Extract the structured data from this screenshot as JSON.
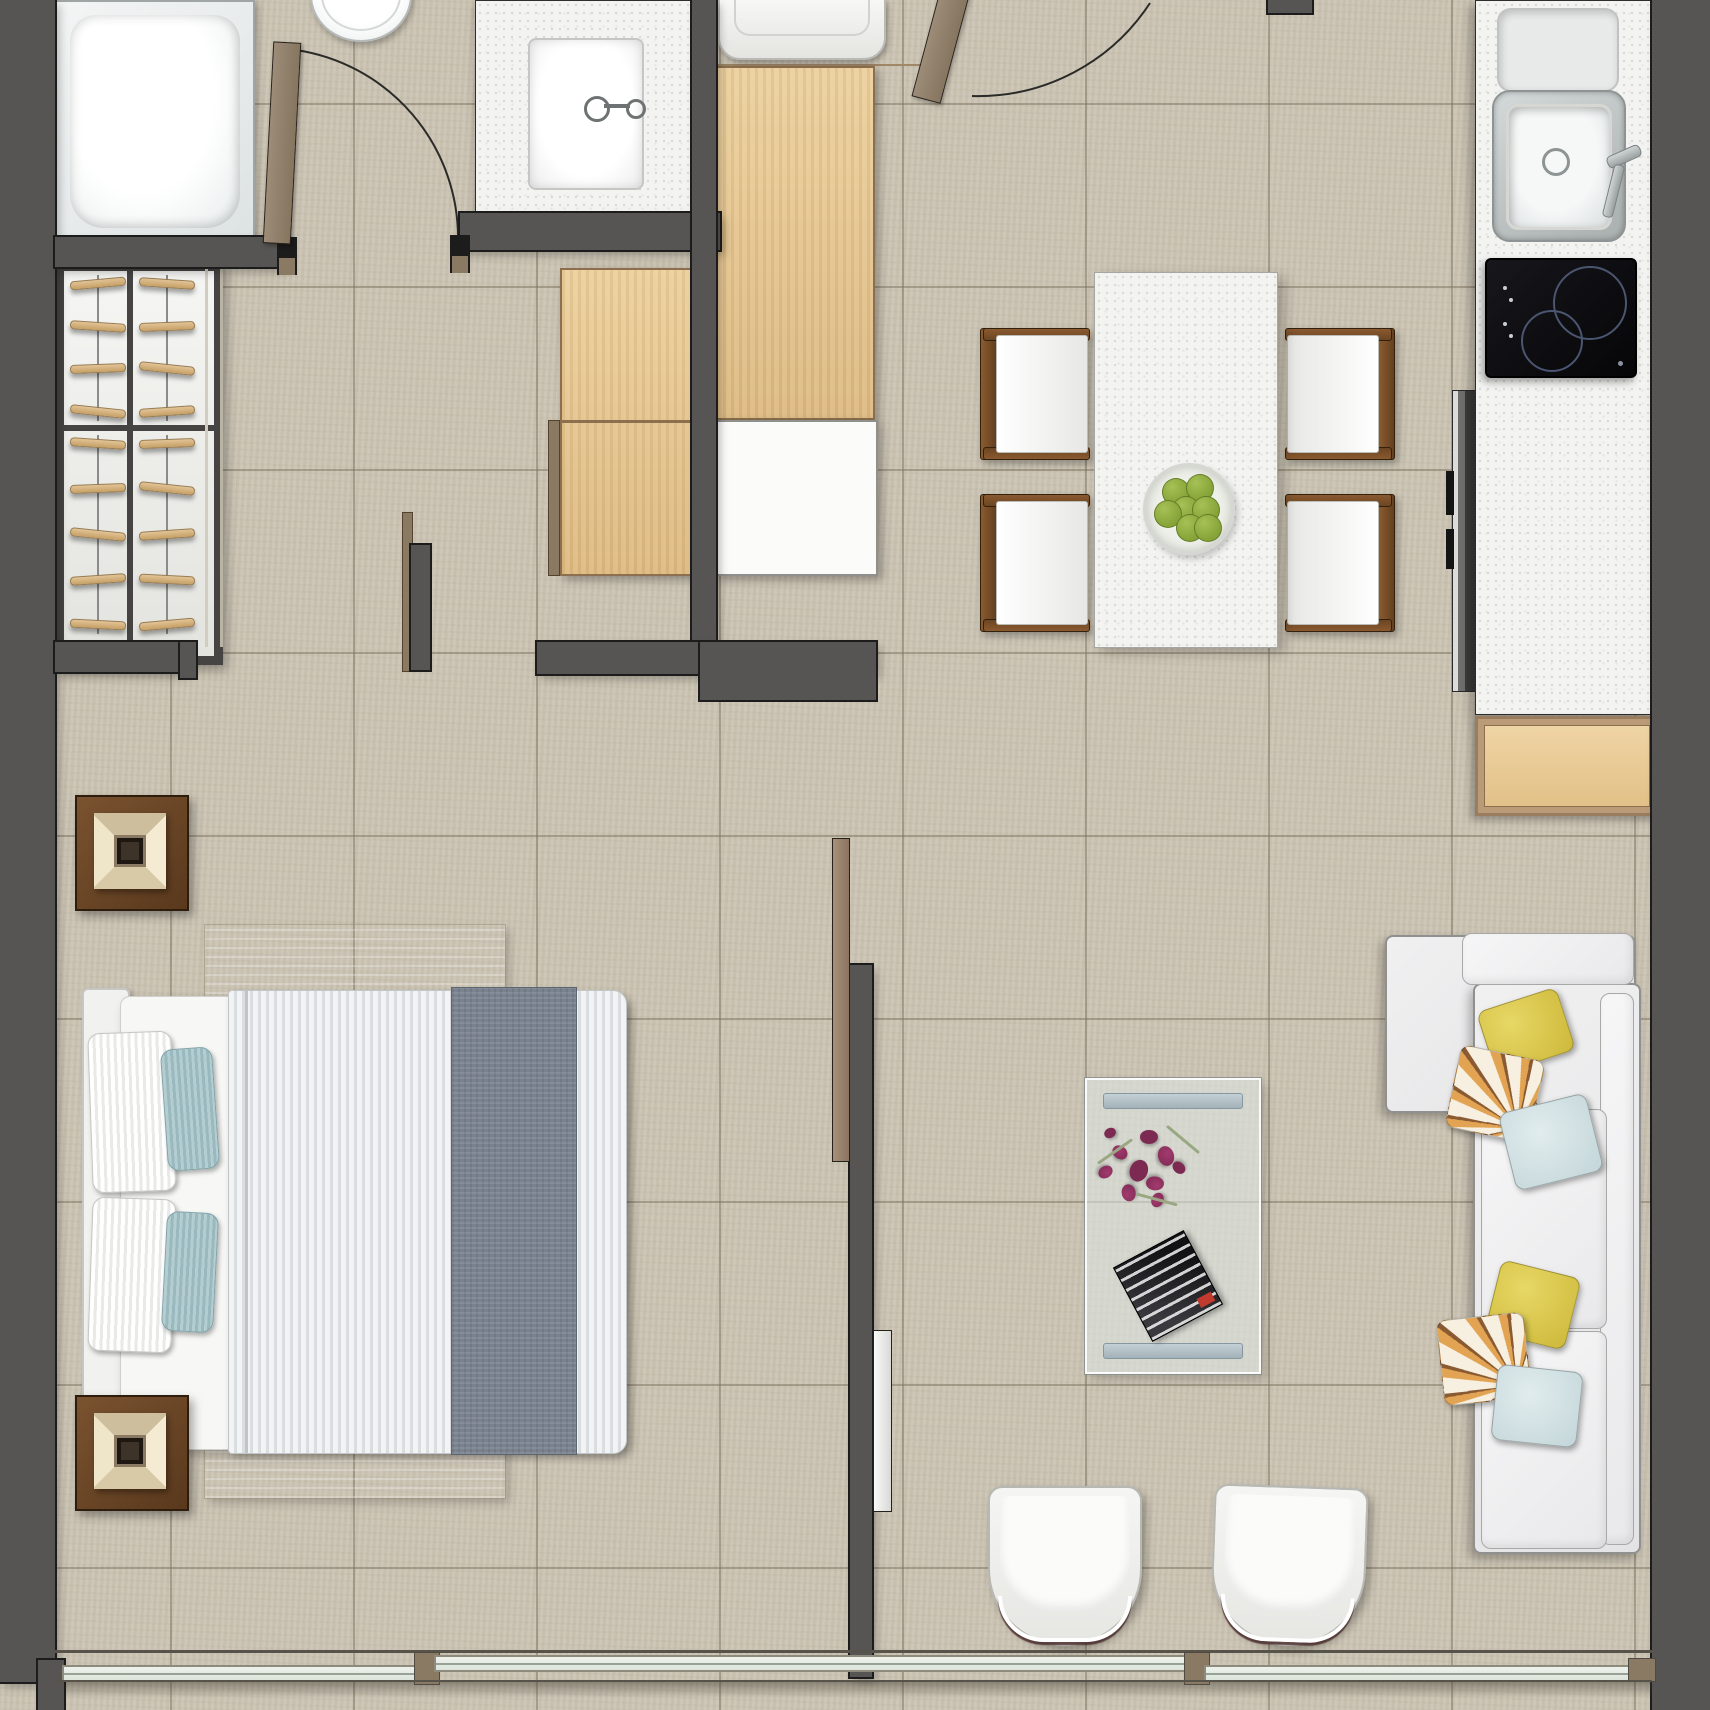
{
  "title": "apartment-floor-plan-top-view",
  "palette": {
    "floor": "#cbc4b4",
    "wall": "#565554",
    "wallDark": "#1c1c1c",
    "woodLight": "#ecd09d",
    "woodDark": "#ddba82",
    "woodTrim": "#8c6f4e",
    "tan": "#8a7a64",
    "fixtureWhite": "#f6f6f4",
    "fixtureBorder": "#b9bcbc",
    "counter": "#f3f3f1",
    "winFrame": "#8e8a7c",
    "apple": "#85a338",
    "flower": "#a23a6e",
    "flowerDark": "#7d2a52",
    "leaf": "#9aa783"
  },
  "rooms": [
    {
      "name": "bathroom",
      "furniture": [
        "bathtub",
        "toilet",
        "vanity-sink",
        "bathroom-door"
      ]
    },
    {
      "name": "entry",
      "furniture": [
        "entry-door",
        "entry-cabinet"
      ]
    },
    {
      "name": "dressing-area",
      "furniture": [
        "wardrobe-with-hangers",
        "tall-wood-cabinet",
        "low-wood-cabinet",
        "white-cabinet"
      ]
    },
    {
      "name": "kitchen",
      "furniture": [
        "kitchen-counter",
        "kitchen-sink",
        "cooktop",
        "tall-cabinet",
        "base-cabinet"
      ]
    },
    {
      "name": "dining-area",
      "furniture": [
        "dining-table",
        "dining-chairs",
        "fruit-bowl"
      ]
    },
    {
      "name": "bedroom",
      "furniture": [
        "double-bed",
        "nightstands",
        "bedside-lamps",
        "area-rug"
      ]
    },
    {
      "name": "living-area",
      "furniture": [
        "sectional-sofa",
        "coffee-table",
        "armchairs",
        "flower-decor",
        "magazine"
      ]
    },
    {
      "name": "balcony",
      "furniture": [
        "sliding-glass-windows"
      ]
    }
  ],
  "counts": {
    "dining_chairs": 4,
    "sofa_pillows": 6,
    "bed_pillows": 4,
    "apples": 7,
    "armchairs": 2,
    "nightstands": 2,
    "cooktop_burners": 2,
    "window_panels": 3,
    "flower_petals": 10
  },
  "closet": {
    "bays": 2,
    "sections": [
      {
        "height": 154,
        "hangers_per_bay": 4
      },
      {
        "height": 207,
        "hangers_per_bay": 5
      }
    ]
  }
}
